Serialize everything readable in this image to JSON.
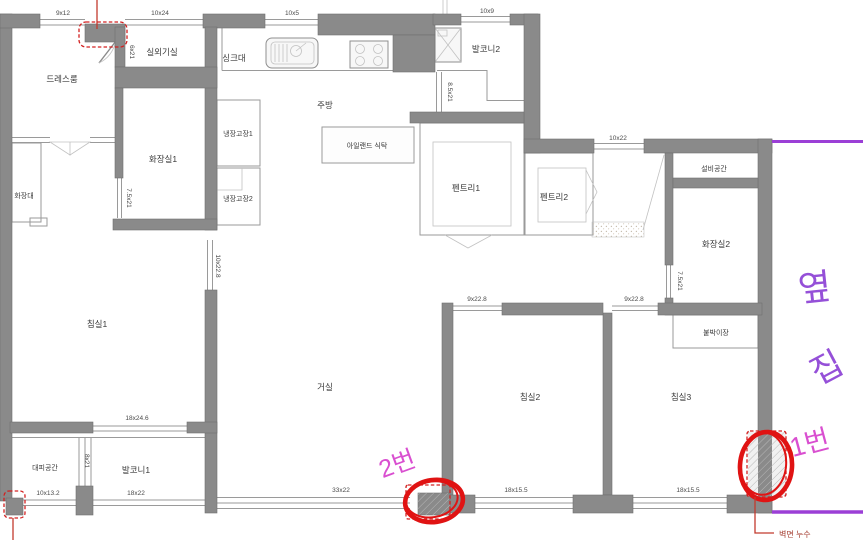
{
  "title": "아파트 평면도 (apartment floor plan with leak annotations)",
  "colors": {
    "wall_gray": "#8a8a8a",
    "annotation_red": "#e01313",
    "leak_label_red": "#a3392c",
    "marker_magenta": "#d94fd0",
    "hand_purple": "#9550d8"
  },
  "plan": {
    "rooms": [
      {
        "label": "드레스룸"
      },
      {
        "label": "실외기실"
      },
      {
        "label": "싱크대"
      },
      {
        "label": "주방"
      },
      {
        "label": "아일랜드 식탁"
      },
      {
        "label": "발코니2"
      },
      {
        "label": "화장실1"
      },
      {
        "label": "화장대"
      },
      {
        "label": "냉장고장1"
      },
      {
        "label": "냉장고장2"
      },
      {
        "label": "펜트리1"
      },
      {
        "label": "펜트리2"
      },
      {
        "label": "설비공간"
      },
      {
        "label": "화장실2"
      },
      {
        "label": "붙박이장"
      },
      {
        "label": "침실1"
      },
      {
        "label": "거실"
      },
      {
        "label": "침실2"
      },
      {
        "label": "침실3"
      },
      {
        "label": "대피공간"
      },
      {
        "label": "발코니1"
      }
    ],
    "dimensions": [
      {
        "label": "9x12"
      },
      {
        "label": "10x24"
      },
      {
        "label": "10x5"
      },
      {
        "label": "10x9"
      },
      {
        "label": "6x21"
      },
      {
        "label": "8.5x21"
      },
      {
        "label": "10x22"
      },
      {
        "label": "7.5x21"
      },
      {
        "label": "7.5x21"
      },
      {
        "label": "10x22.8"
      },
      {
        "label": "9x22.8"
      },
      {
        "label": "9x22.8"
      },
      {
        "label": "18x24.6"
      },
      {
        "label": "8x21"
      },
      {
        "label": "10x13.2"
      },
      {
        "label": "18x22"
      },
      {
        "label": "33x22"
      },
      {
        "label": "18x15.5"
      },
      {
        "label": "18x15.5"
      }
    ],
    "annotations": {
      "wall_leak_label": "벽면 누수",
      "spot_1_label": "1번",
      "spot_2_label": "2번",
      "neighbor_char_1": "옆",
      "neighbor_char_2": "집"
    }
  }
}
